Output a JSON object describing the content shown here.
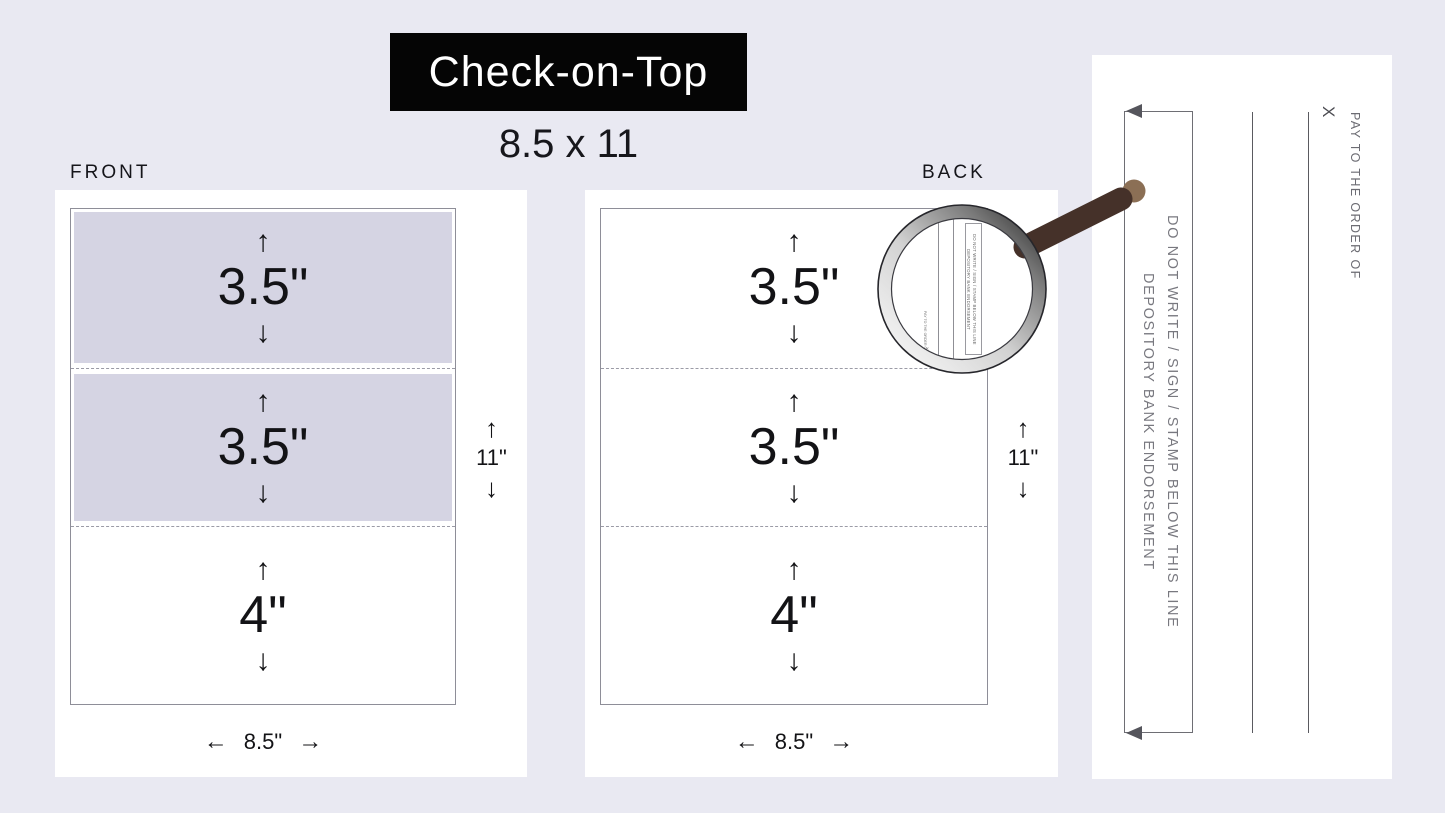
{
  "title": {
    "text": "Check-on-Top",
    "size": "8.5 x 11"
  },
  "front": {
    "label": "FRONT",
    "sections": [
      {
        "height_label": "3.5\""
      },
      {
        "height_label": "3.5\""
      },
      {
        "height_label": "4\""
      }
    ],
    "width_label": "8.5\"",
    "height_label": "11\""
  },
  "back": {
    "label": "BACK",
    "sections": [
      {
        "height_label": "3.5\""
      },
      {
        "height_label": "3.5\""
      },
      {
        "height_label": "4\""
      }
    ],
    "width_label": "8.5\"",
    "height_label": "11\""
  },
  "endorsement": {
    "do_not_write": "DO NOT WRITE / SIGN / STAMP BELOW THIS LINE",
    "depository": "DEPOSITORY BANK ENDORSEMENT",
    "pay_to": "PAY TO THE ORDER OF",
    "x_mark": "X"
  },
  "glyphs": {
    "up": "↑",
    "down": "↓",
    "left": "←",
    "right": "→"
  },
  "colors": {
    "background": "#e9e9f2",
    "panel": "#ffffff",
    "section_shade": "#d5d4e3",
    "title_bg": "#050505",
    "title_fg": "#ffffff",
    "text": "#131316",
    "muted_text": "#78787f",
    "handle": "#453129",
    "handle_tip": "#8b6f55"
  }
}
